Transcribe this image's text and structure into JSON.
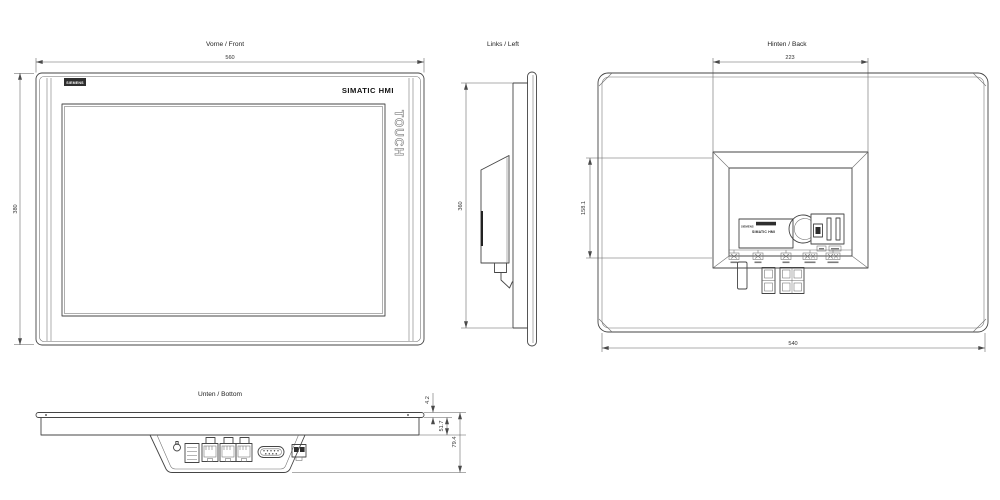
{
  "page": {
    "background": "#ffffff",
    "line_color": "#454545"
  },
  "views": {
    "front": {
      "title": "Vorne / Front",
      "dim_width": "560",
      "dim_height": "380",
      "brand": "SIEMENS",
      "product": "SIMATIC HMI",
      "touch": "TOUCH"
    },
    "left": {
      "title": "Links / Left",
      "dim_height": "360"
    },
    "back": {
      "title": "Hinten / Back",
      "dim_recess_width": "223",
      "dim_width": "540",
      "dim_side": "158.1",
      "label_plate": {
        "brand": "SIEMENS",
        "model": "SIMATIC HMI"
      }
    },
    "bottom": {
      "title": "Unten / Bottom",
      "dim_front": "4.2",
      "dim_body": "51.7",
      "dim_total": "79.4",
      "connector_icons": [
        "grounding-screw",
        "power-terminal",
        "rj45-double",
        "rj45-single",
        "db9-serial",
        "usb-dual"
      ]
    }
  }
}
